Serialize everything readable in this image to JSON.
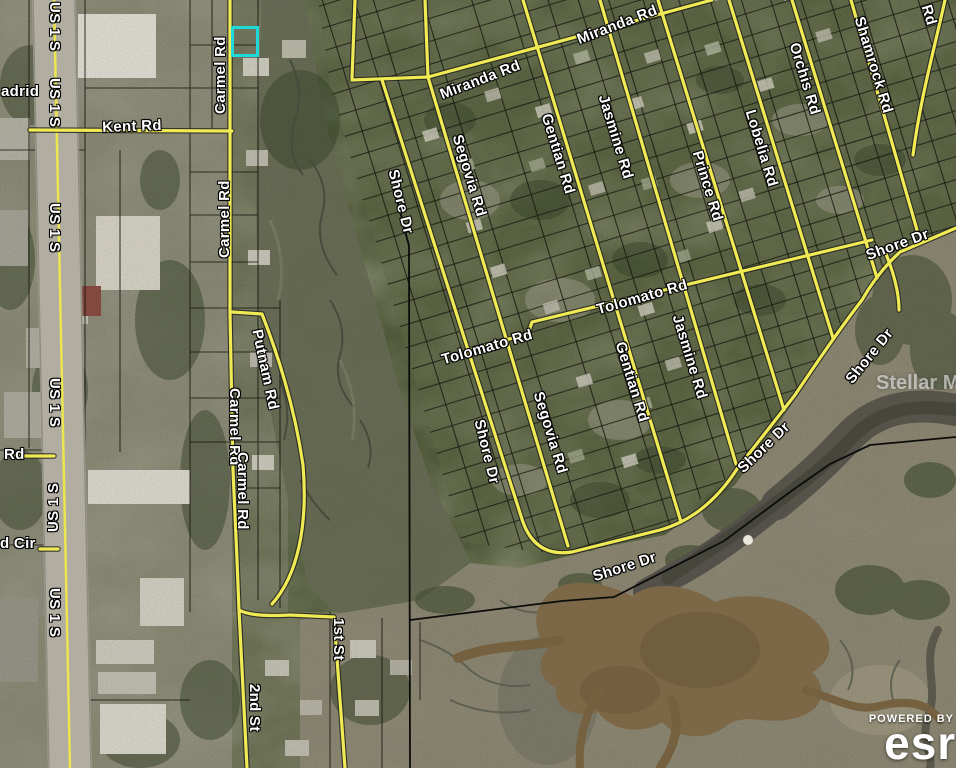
{
  "map": {
    "type": "aerial-parcel-map",
    "highlight_color": "#1ed8da",
    "road_color": "#f0ea55",
    "watermark": "Stellar MLS",
    "attribution": {
      "powered_by": "POWERED BY",
      "brand": "esri"
    },
    "labels": [
      {
        "id": "us1s-1",
        "text": "US 1 S"
      },
      {
        "id": "us1s-2",
        "text": "US 1 S"
      },
      {
        "id": "us1s-3",
        "text": "US 1 S"
      },
      {
        "id": "us1s-4",
        "text": "US 1 S"
      },
      {
        "id": "us1s-5",
        "text": "US 1 S"
      },
      {
        "id": "us1s-6",
        "text": "US 1 S"
      },
      {
        "id": "madrid",
        "text": "adrid"
      },
      {
        "id": "rd-left",
        "text": "Rd"
      },
      {
        "id": "d-cir",
        "text": "d Cir"
      },
      {
        "id": "kent",
        "text": "Kent Rd"
      },
      {
        "id": "carmel-1",
        "text": "Carmel Rd"
      },
      {
        "id": "carmel-2",
        "text": "Carmel Rd"
      },
      {
        "id": "carmel-3",
        "text": "Carmel Rd"
      },
      {
        "id": "carmel-4",
        "text": "Carmel Rd"
      },
      {
        "id": "putnam",
        "text": "Putnam Rd"
      },
      {
        "id": "second-st",
        "text": "2nd St"
      },
      {
        "id": "first-st",
        "text": "1st St"
      },
      {
        "id": "miranda-1",
        "text": "Miranda Rd"
      },
      {
        "id": "miranda-2",
        "text": "Miranda Rd"
      },
      {
        "id": "segovia-1",
        "text": "Segovia Rd"
      },
      {
        "id": "segovia-2",
        "text": "Segovia Rd"
      },
      {
        "id": "gentian-1",
        "text": "Gentian Rd"
      },
      {
        "id": "gentian-2",
        "text": "Gentian Rd"
      },
      {
        "id": "jasmine-1",
        "text": "Jasmine Rd"
      },
      {
        "id": "jasmine-2",
        "text": "Jasmine Rd"
      },
      {
        "id": "prince",
        "text": "Prince Rd"
      },
      {
        "id": "lobelia",
        "text": "Lobelia Rd"
      },
      {
        "id": "orchis",
        "text": "Orchis Rd"
      },
      {
        "id": "shamrock",
        "text": "Shamrock Rd"
      },
      {
        "id": "rd-corner",
        "text": "Rd"
      },
      {
        "id": "tolomato-1",
        "text": "Tolomato Rd"
      },
      {
        "id": "tolomato-2",
        "text": "Tolomato Rd"
      },
      {
        "id": "shore-w1",
        "text": "Shore Dr"
      },
      {
        "id": "shore-w2",
        "text": "Shore Dr"
      },
      {
        "id": "shore-bottom",
        "text": "Shore Dr"
      },
      {
        "id": "shore-diag",
        "text": "Shore Dr"
      },
      {
        "id": "shore-steep",
        "text": "Shore Dr"
      },
      {
        "id": "shore-tr",
        "text": "Shore Dr"
      }
    ]
  }
}
